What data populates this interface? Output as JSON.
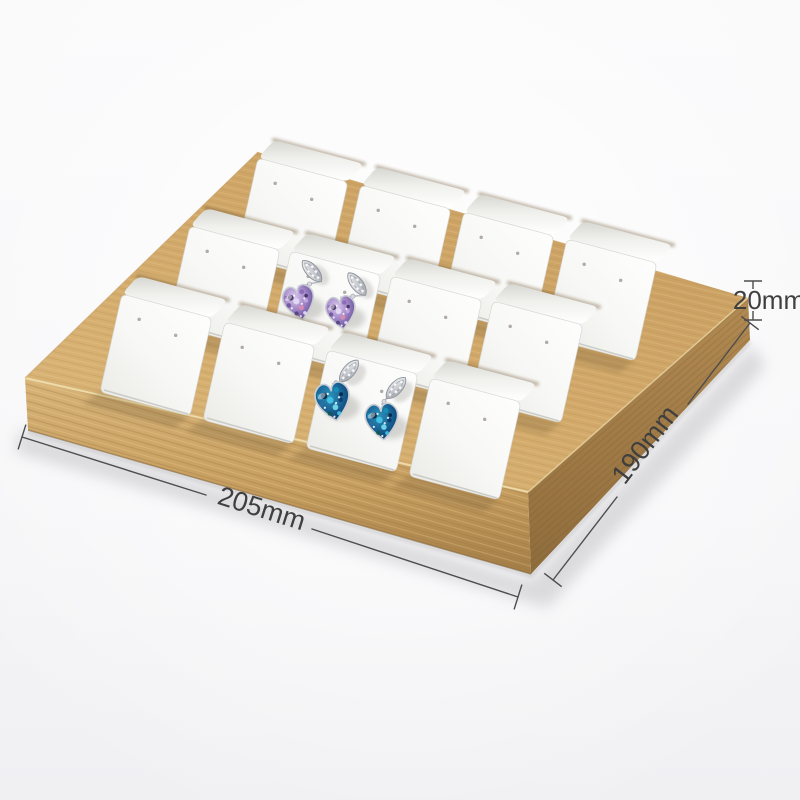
{
  "scene": {
    "description": "Bamboo wood jewelry display tray holding 12 white leather earring cards in 3 rows of 4; two cards display crystal heart drop earrings (one purple pair, one blue pair); dimension callouts are drawn around the tray",
    "background_top": "#fafafb",
    "background_bottom": "#f0f0f3"
  },
  "annotations": {
    "width_label": "205mm",
    "depth_label": "190mm",
    "height_label": "20mm",
    "line_color": "#4d4d4d",
    "text_color": "#3f3f3f",
    "font_size": 27,
    "height_font_size": 26
  },
  "tray": {
    "rows": 3,
    "columns": 4,
    "card_slots": 12,
    "wood": {
      "top_light": "#dcb87a",
      "top_dark": "#c69c5e",
      "front_light": "#d8b478",
      "front_mid": "#c79e60",
      "front_dark": "#a37d46",
      "right_light": "#b28a52",
      "right_dark": "#8f6c3c",
      "edge_highlight": "#f0dfae",
      "slot_shadow": "#6f5731",
      "grain_dark": "#9b7743",
      "grain_light": "#ecd49c"
    },
    "card": {
      "face_white": "#ffffff",
      "face_shade": "#e8e8e4",
      "flap_back": "#d8d8d3",
      "bottom_edge": "#c9c9c4",
      "hole_color": "#a8a29a"
    },
    "grid": {
      "row_tl": [
        [
          258,
          158
        ],
        [
          190,
          226
        ],
        [
          122,
          294
        ]
      ],
      "col_step": [
        [
          103,
          27
        ],
        [
          101,
          25
        ],
        [
          103,
          28
        ]
      ],
      "face_u": [
        90,
        24
      ],
      "face_v": [
        -22,
        98
      ],
      "flap_w": [
        16,
        -18
      ],
      "hole_frac": [
        [
          0.24,
          0.2
        ],
        [
          0.66,
          0.26
        ]
      ]
    },
    "outline": {
      "top": [
        [
          25,
          378
        ],
        [
          258,
          152
        ],
        [
          748,
          298
        ],
        [
          528,
          492
        ]
      ],
      "front": [
        [
          25,
          378
        ],
        [
          528,
          492
        ],
        [
          531,
          574
        ],
        [
          28,
          430
        ]
      ],
      "right": [
        [
          528,
          492
        ],
        [
          748,
          298
        ],
        [
          750,
          340
        ],
        [
          531,
          574
        ]
      ]
    }
  },
  "earrings": [
    {
      "name": "purple-crystal-heart-pair",
      "card_position": "row 2, column 2",
      "gem": "purple",
      "items": [
        {
          "leaf": [
            312,
            271,
            -42
          ],
          "heart": [
            299,
            302,
            -12,
            19
          ]
        },
        {
          "leaf": [
            357,
            284,
            -38
          ],
          "heart": [
            341,
            312,
            -8,
            18
          ]
        }
      ]
    },
    {
      "name": "blue-crystal-heart-pair",
      "card_position": "row 3, column 3",
      "gem": "blue",
      "items": [
        {
          "leaf": [
            349,
            371,
            40
          ],
          "heart": [
            333,
            401,
            -10,
            21
          ]
        },
        {
          "leaf": [
            396,
            388,
            42
          ],
          "heart": [
            382,
            421,
            -6,
            20
          ]
        }
      ]
    }
  ],
  "gem_palettes": {
    "purple": {
      "spots": [
        "#3f2f5e",
        "#8a68b4",
        "#e6dcf5",
        "#c4a8e0",
        "#6e549c",
        "#d98bb4",
        "#51407c"
      ]
    },
    "blue": {
      "spots": [
        "#06233f",
        "#1591b8",
        "#45c6e8",
        "#0a3d6b",
        "#2a6fa0",
        "#79dff0",
        "#0f5a50"
      ]
    }
  }
}
